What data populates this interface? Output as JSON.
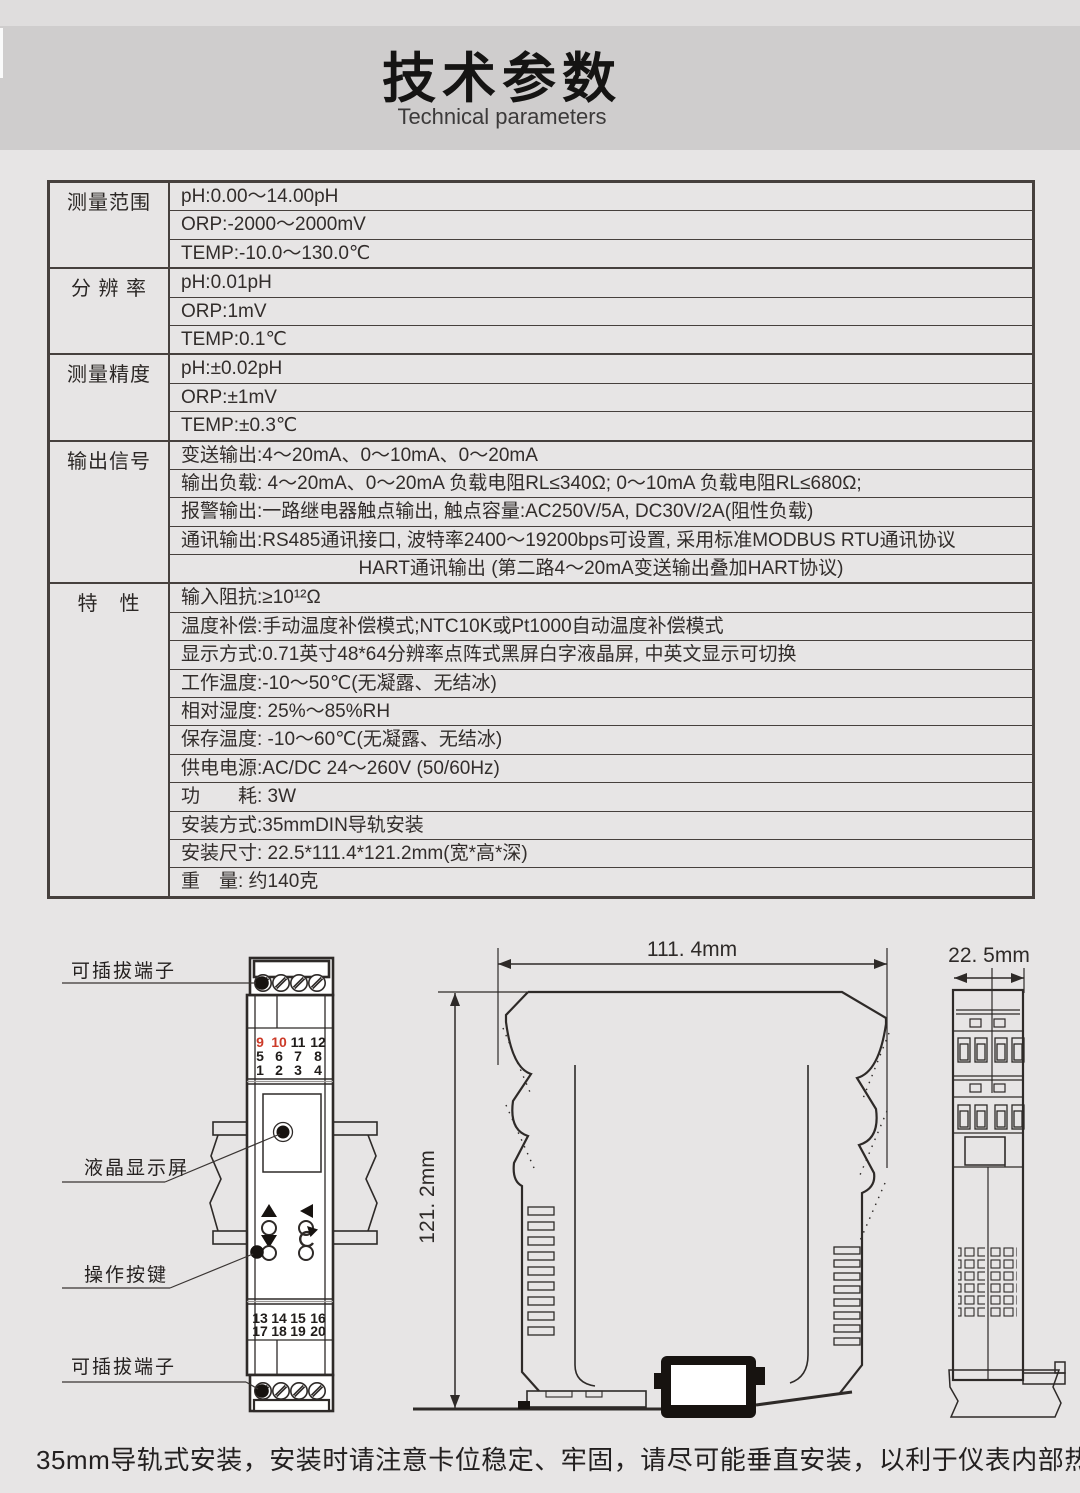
{
  "page": {
    "title": "技术参数",
    "subtitle": "Technical parameters",
    "footer": "35mm导轨式安装，安装时请注意卡位稳定、牢固，请尽可能垂直安装，以利于仪表内部热量散发。"
  },
  "palette": {
    "terminal_red": "#cc3a28",
    "line_dark": "#2e2a28",
    "table_border": "#46403d",
    "band_bg": "#cfcdcd",
    "page_bg": "#e7e5e5"
  },
  "spec_table": {
    "groups": [
      {
        "label": "测量范围",
        "rows": [
          {
            "text": "pH:0.00～14.00pH"
          },
          {
            "text": "ORP:-2000～2000mV"
          },
          {
            "text": "TEMP:-10.0～130.0℃"
          }
        ]
      },
      {
        "label": "分 辨 率",
        "rows": [
          {
            "text": "pH:0.01pH"
          },
          {
            "text": "ORP:1mV"
          },
          {
            "text": "TEMP:0.1℃"
          }
        ]
      },
      {
        "label": "测量精度",
        "rows": [
          {
            "text": "pH:±0.02pH"
          },
          {
            "text": "ORP:±1mV"
          },
          {
            "text": "TEMP:±0.3℃"
          }
        ]
      },
      {
        "label": "输出信号",
        "rows": [
          {
            "text": "变送输出:4～20mA、0～10mA、0～20mA"
          },
          {
            "text": "输出负载: 4～20mA、0～20mA 负载电阻RL≤340Ω; 0～10mA 负载电阻RL≤680Ω;"
          },
          {
            "text": "报警输出:一路继电器触点输出, 触点容量:AC250V/5A, DC30V/2A(阻性负载)"
          },
          {
            "text": "通讯输出:RS485通讯接口, 波特率2400～19200bps可设置, 采用标准MODBUS RTU通讯协议"
          },
          {
            "text": "HART通讯输出 (第二路4～20mA变送输出叠加HART协议)",
            "center": true
          }
        ]
      },
      {
        "label": "特　性",
        "rows": [
          {
            "text": "输入阻抗:≥10¹²Ω"
          },
          {
            "text": "温度补偿:手动温度补偿模式;NTC10K或Pt1000自动温度补偿模式"
          },
          {
            "text": "显示方式:0.71英寸48*64分辨率点阵式黑屏白字液晶屏, 中英文显示可切换"
          },
          {
            "text": "工作温度:-10～50℃(无凝露、无结冰)"
          },
          {
            "text": "相对湿度: 25%～85%RH"
          },
          {
            "text": "保存温度: -10～60℃(无凝露、无结冰)"
          },
          {
            "text": "供电电源:AC/DC 24～260V (50/60Hz)"
          },
          {
            "text": "功　　耗: 3W"
          },
          {
            "text": "安装方式:35mmDIN导轨安装"
          },
          {
            "text": "安装尺寸: 22.5*111.4*121.2mm(宽*高*深)"
          },
          {
            "text": "重　量: 约140克"
          }
        ]
      }
    ]
  },
  "front_view": {
    "labels": {
      "top_terminal": "可插拔端子",
      "lcd": "液晶显示屏",
      "keys": "操作按键",
      "bottom_terminal": "可插拔端子"
    },
    "terminals_top": [
      [
        "9",
        "10",
        "11",
        "12"
      ],
      [
        "5",
        "6",
        "7",
        "8"
      ],
      [
        "1",
        "2",
        "3",
        "4"
      ]
    ],
    "terminals_bottom": [
      [
        "13",
        "14",
        "15",
        "16"
      ],
      [
        "17",
        "18",
        "19",
        "20"
      ]
    ]
  },
  "side_view": {
    "width_label": "111. 4mm",
    "height_label": "121. 2mm"
  },
  "end_view": {
    "width_label": "22. 5mm"
  }
}
